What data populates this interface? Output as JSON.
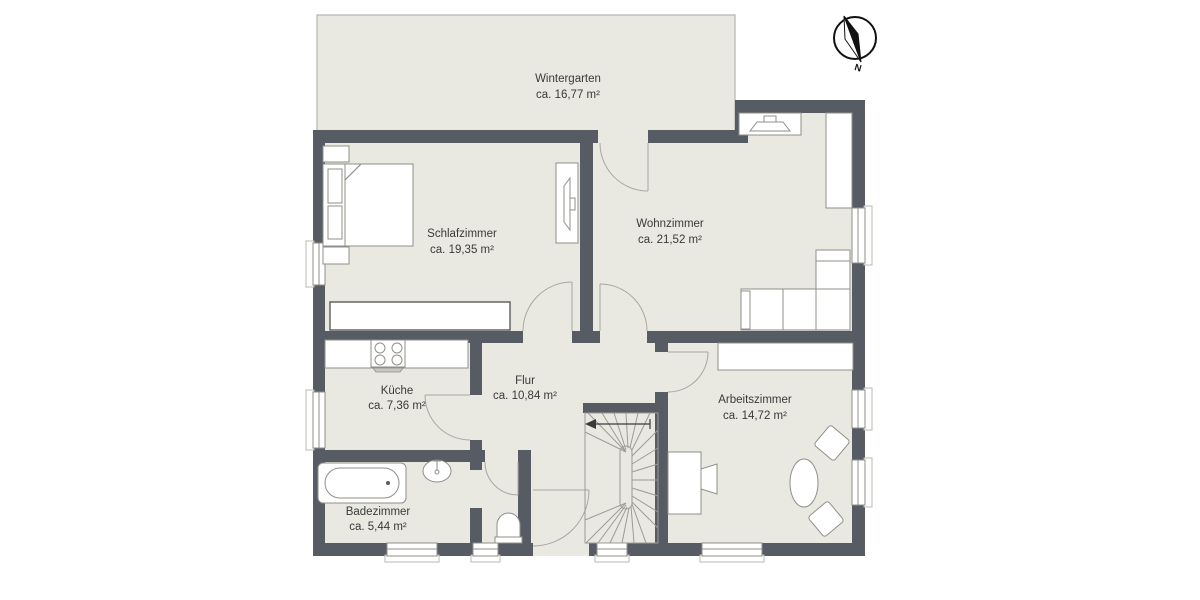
{
  "document_type": "floor-plan",
  "colors": {
    "wall": "#575c64",
    "floor": "#e9e8e1",
    "furniture": "#ffffff",
    "outline": "#8f8f8a",
    "line": "#9c9c96",
    "text": "#3a3a3a",
    "wintergarten_outline": "#b5b5af",
    "background": "#ffffff",
    "compass": "#111111"
  },
  "compass": {
    "label": "N"
  },
  "rooms": [
    {
      "id": "wintergarten",
      "name": "Wintergarten",
      "area": "ca. 16,77 m²"
    },
    {
      "id": "schlafzimmer",
      "name": "Schlafzimmer",
      "area": "ca. 19,35 m²"
    },
    {
      "id": "wohnzimmer",
      "name": "Wohnzimmer",
      "area": "ca. 21,52 m²"
    },
    {
      "id": "kueche",
      "name": "Küche",
      "area": "ca. 7,36 m²"
    },
    {
      "id": "flur",
      "name": "Flur",
      "area": "ca. 10,84 m²"
    },
    {
      "id": "arbeitszimmer",
      "name": "Arbeitszimmer",
      "area": "ca. 14,72 m²"
    },
    {
      "id": "badezimmer",
      "name": "Badezimmer",
      "area": "ca. 5,44 m²"
    }
  ],
  "icons": {
    "compass": "compass-rose-icon",
    "furniture": [
      "bed-icon",
      "nightstand-icon",
      "tv-icon",
      "sideboard-icon",
      "wardrobe-icon",
      "sofa-icon",
      "stove-icon",
      "kitchen-counter-icon",
      "bathtub-icon",
      "sink-icon",
      "toilet-icon",
      "desk-icon",
      "office-chair-icon",
      "oval-table-icon",
      "chair-icon",
      "staircase-icon",
      "stair-direction-arrow-icon",
      "door-swing-icon",
      "window-icon"
    ]
  }
}
